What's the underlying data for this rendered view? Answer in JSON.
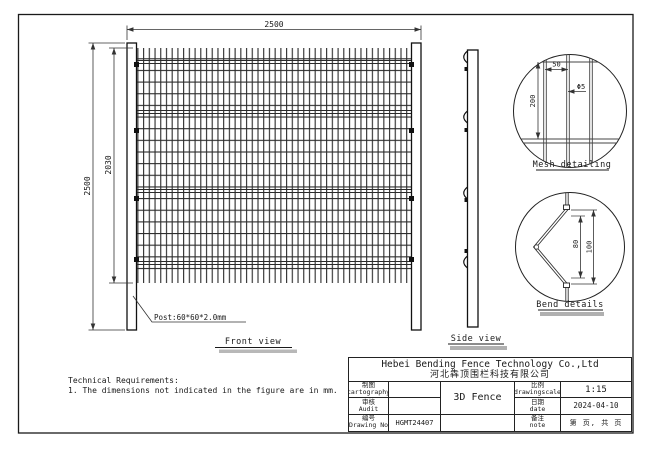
{
  "drawing": {
    "front_view": {
      "label": "Front view",
      "dim_width": "2500",
      "dim_height_outer": "2500",
      "dim_height_mesh": "2030",
      "post_note": "Post:60*60*2.0mm"
    },
    "side_view": {
      "label": "Side view"
    },
    "mesh_detail": {
      "label": "Mesh detailing",
      "dim_horizontal_spacing": "50",
      "dim_vertical_spacing": "200",
      "wire_diameter": "Φ5"
    },
    "bend_detail": {
      "label": "Bend details",
      "dim_inner": "80",
      "dim_outer": "100"
    },
    "tech_req": {
      "title": "Technical Requirements:",
      "item1": "1. The dimensions not indicated in the figure are in mm."
    }
  },
  "title_block": {
    "company_en": "Hebei Bending Fence Technology Co.,Ltd",
    "company_cn": "河北犇顶围栏科技有限公司",
    "cartography_cn": "制图",
    "cartography_en": "cartography",
    "audit_cn": "审核",
    "audit_en": "Audit",
    "drawing_no_cn": "编号",
    "drawing_no_en": "Drawing No",
    "drawing_no_value": "HGMT24407",
    "product": "3D Fence",
    "scale_cn": "比例",
    "scale_en": "drawingscale",
    "scale_value": "1:15",
    "date_cn": "日期",
    "date_en": "date",
    "date_value": "2024-04-10",
    "note_cn": "备注",
    "note_en": "note",
    "note_value": "第 页, 共 页"
  },
  "colors": {
    "line": "#1a1a1a",
    "dim_line": "#333333",
    "label_shadow": "#b0b0b0"
  }
}
